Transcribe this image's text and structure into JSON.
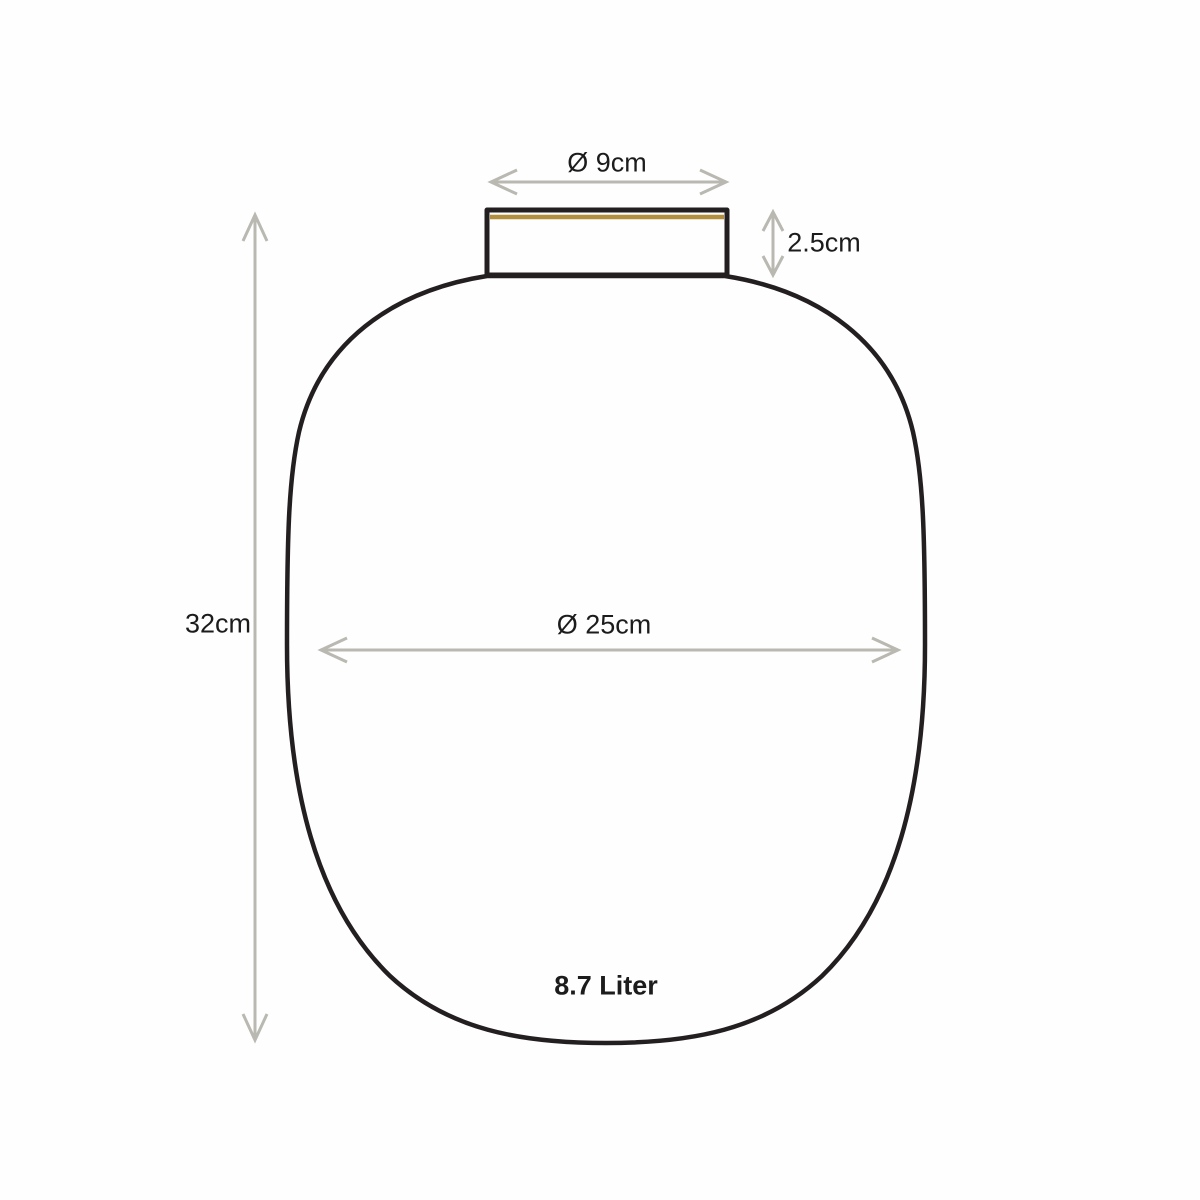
{
  "diagram": {
    "labels": {
      "neck_diameter": "Ø 9cm",
      "neck_height": "2.5cm",
      "total_height": "32cm",
      "body_diameter": "Ø 25cm",
      "capacity": "8.7 Liter"
    }
  },
  "colors": {
    "background": "#fefefe",
    "outline": "#231f20",
    "gold": "#b28f3e",
    "arrow": "#b9b8b1",
    "text": "#1c1c1c"
  }
}
